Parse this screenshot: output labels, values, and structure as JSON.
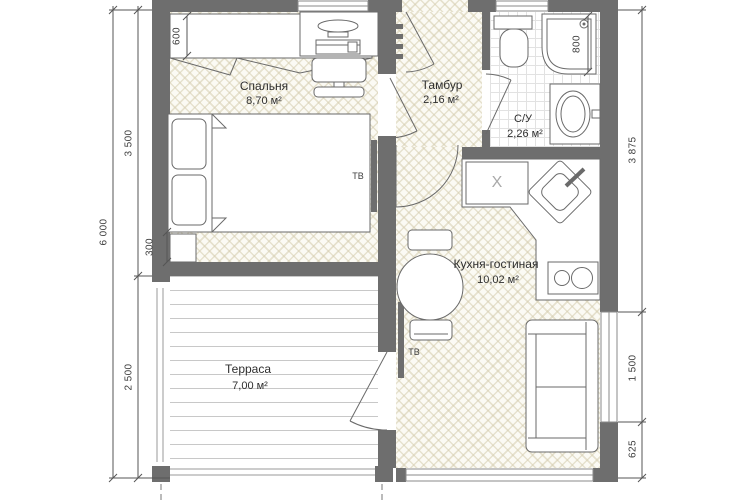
{
  "plan": {
    "rooms": [
      {
        "name": "Спальня",
        "area": "8,70 м²"
      },
      {
        "name": "Тамбур",
        "area": "2,16 м²"
      },
      {
        "name": "С/У",
        "area": "2,26 м²"
      },
      {
        "name": "Кухня-гостиная",
        "area": "10,02 м²"
      },
      {
        "name": "Терраса",
        "area": "7,00 м²"
      }
    ],
    "dimensions": {
      "left_total": "6 000",
      "left_upper": "3 500",
      "left_lower": "2 500",
      "right_upper": "3 875",
      "right_middle": "1 500",
      "right_lower": "625",
      "wardrobe_depth": "600",
      "nightstand_width": "300",
      "shower_width": "800"
    },
    "equipment_labels": {
      "tv_bedroom": "ТВ",
      "tv_kitchen": "ТВ",
      "appliance_mark": "X"
    }
  },
  "colors": {
    "wall": "#6e6e6e",
    "floor_hatch": "#d5cdaf",
    "line": "#6a6a6a",
    "background": "#ffffff"
  }
}
